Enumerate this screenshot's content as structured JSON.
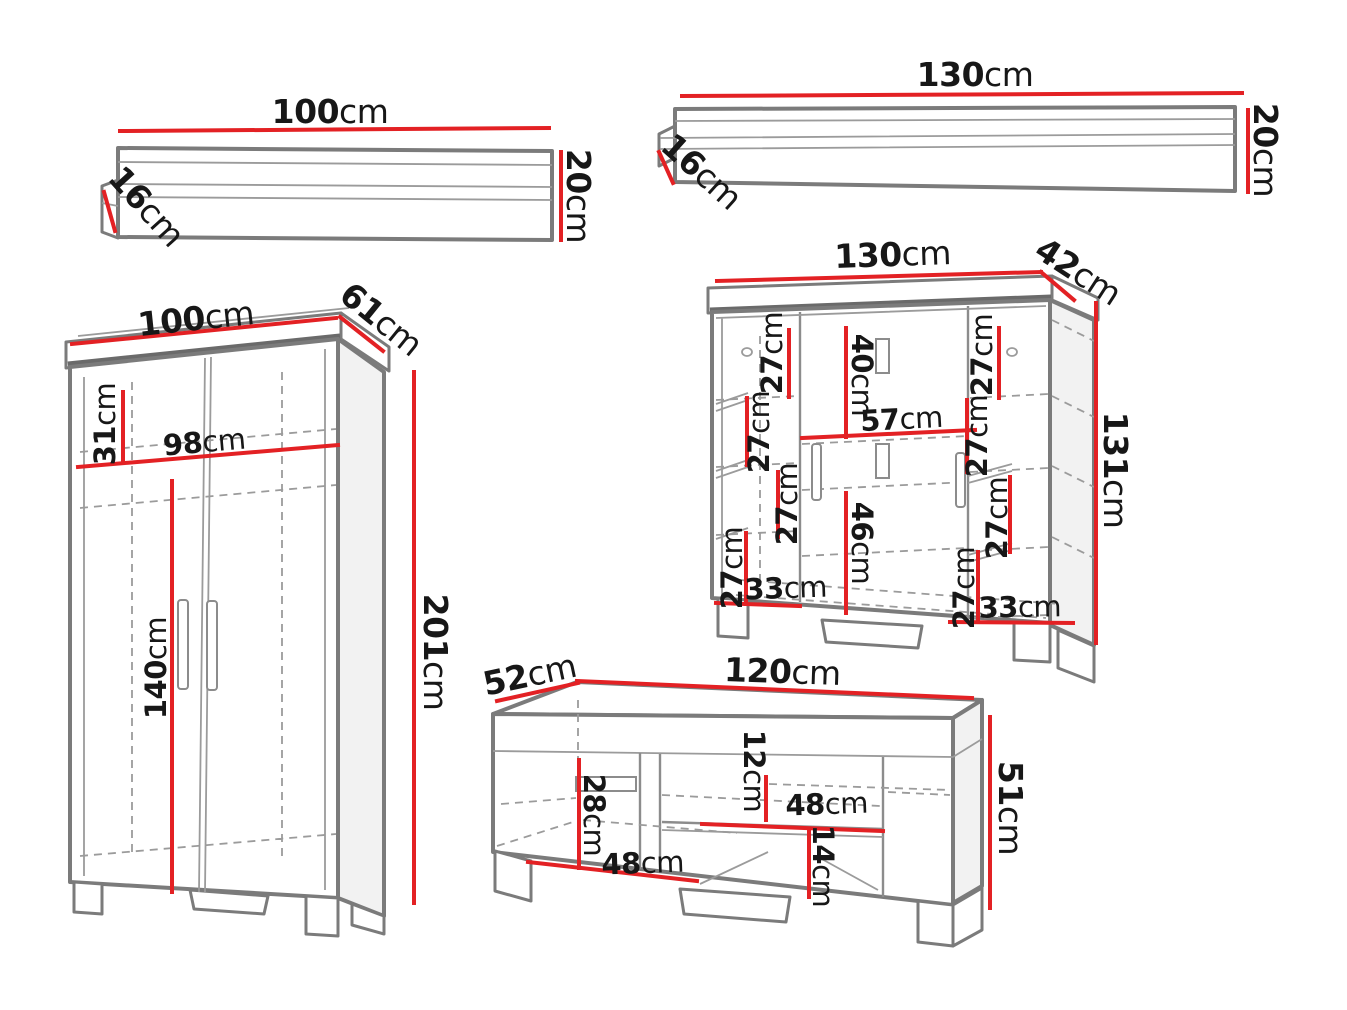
{
  "diagram": {
    "background": "#ffffff",
    "colors": {
      "dimension_line": "#e32124",
      "outline": "#7b7b7b",
      "detail_line": "#9b9b9b",
      "label_text": "#171717",
      "side_face_fill": "#f2f2f2"
    }
  },
  "furniture": {
    "shelf_small": {
      "width": {
        "value": "100",
        "unit": "cm"
      },
      "height": {
        "value": "20",
        "unit": "cm"
      },
      "depth": {
        "value": "16",
        "unit": "cm"
      }
    },
    "shelf_large": {
      "width": {
        "value": "130",
        "unit": "cm"
      },
      "height": {
        "value": "20",
        "unit": "cm"
      },
      "depth": {
        "value": "16",
        "unit": "cm"
      }
    },
    "wardrobe": {
      "width": {
        "value": "100",
        "unit": "cm"
      },
      "depth": {
        "value": "61",
        "unit": "cm"
      },
      "height": {
        "value": "201",
        "unit": "cm"
      },
      "top_compartment_height": {
        "value": "31",
        "unit": "cm"
      },
      "interior_width": {
        "value": "98",
        "unit": "cm"
      },
      "interior_height": {
        "value": "140",
        "unit": "cm"
      }
    },
    "cabinet": {
      "width": {
        "value": "130",
        "unit": "cm"
      },
      "depth": {
        "value": "42",
        "unit": "cm"
      },
      "height": {
        "value": "131",
        "unit": "cm"
      },
      "top_door_height": {
        "value": "40",
        "unit": "cm"
      },
      "middle_width": {
        "value": "57",
        "unit": "cm"
      },
      "bottom_door_height": {
        "value": "46",
        "unit": "cm"
      },
      "left_bottom_width": {
        "value": "33",
        "unit": "cm"
      },
      "right_bottom_width": {
        "value": "33",
        "unit": "cm"
      },
      "left_sections": [
        {
          "value": "27",
          "unit": "cm"
        },
        {
          "value": "27",
          "unit": "cm"
        },
        {
          "value": "27",
          "unit": "cm"
        },
        {
          "value": "27",
          "unit": "cm"
        }
      ],
      "right_sections": [
        {
          "value": "27",
          "unit": "cm"
        },
        {
          "value": "27",
          "unit": "cm"
        },
        {
          "value": "27",
          "unit": "cm"
        },
        {
          "value": "27",
          "unit": "cm"
        }
      ]
    },
    "tv_stand": {
      "depth": {
        "value": "52",
        "unit": "cm"
      },
      "width": {
        "value": "120",
        "unit": "cm"
      },
      "height": {
        "value": "51",
        "unit": "cm"
      },
      "left_door_height": {
        "value": "28",
        "unit": "cm"
      },
      "niche_top_offset": {
        "value": "12",
        "unit": "cm"
      },
      "niche_width": {
        "value": "48",
        "unit": "cm"
      },
      "base_height": {
        "value": "14",
        "unit": "cm"
      },
      "left_interior_width": {
        "value": "48",
        "unit": "cm"
      }
    }
  }
}
